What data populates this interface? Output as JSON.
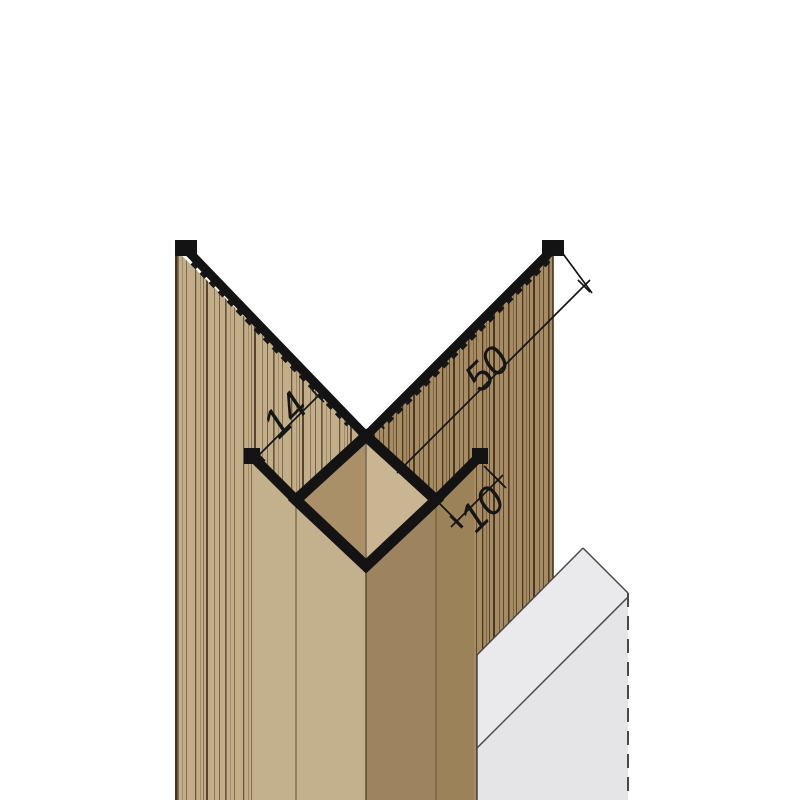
{
  "drawing": {
    "title": "corner-profile-technical-drawing",
    "dimensions": {
      "panel_thickness": "14",
      "wing_width": "50",
      "face_leg": "10"
    },
    "colors": {
      "profile_black": "#131313",
      "panel_left_face": "#c3ae8a",
      "panel_left_plain": "#c3b08c",
      "panel_right_face": "#a78c63",
      "panel_right_plain": "#9c8258",
      "core_left_face": "#aa9069",
      "core_right_face": "#c9b592",
      "board_top": "#eaeaec",
      "board_front": "#e5e5e7",
      "grain_line": "#4a3a24",
      "background": "#ffffff"
    },
    "parts": {
      "left_panel": "cladding-panel-left",
      "right_panel": "cladding-panel-right",
      "core": "corner-profile-core",
      "left_wing": "profile-wing-left",
      "right_wing": "profile-wing-right",
      "board": "insulation-board"
    }
  }
}
